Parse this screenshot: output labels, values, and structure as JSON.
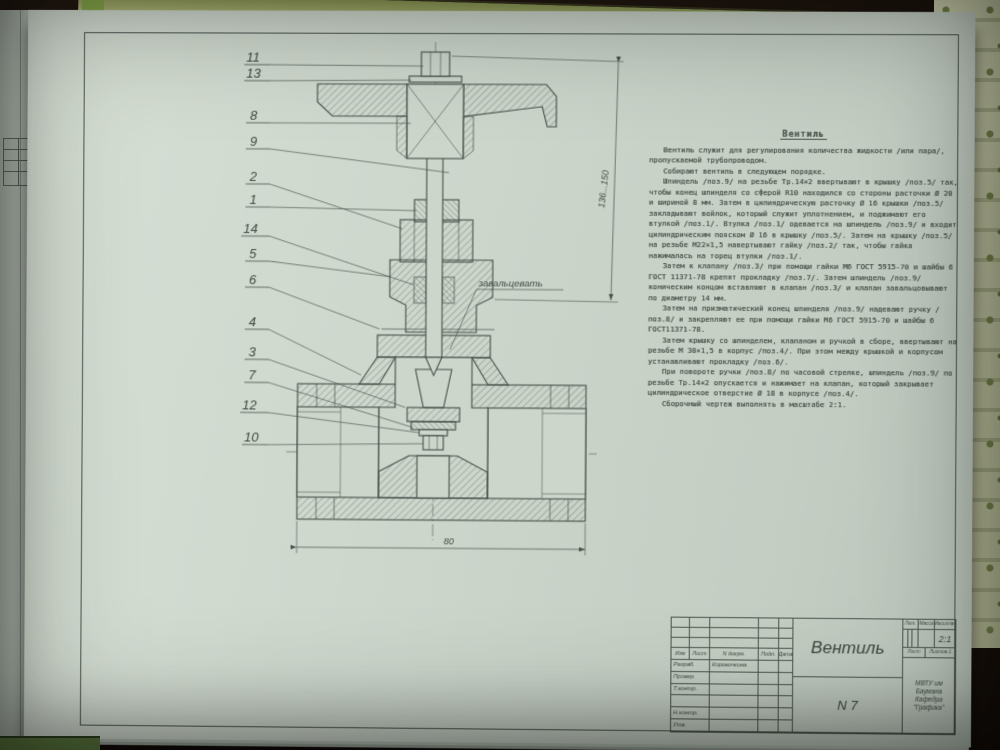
{
  "colors": {
    "paper": "#ccd6cb",
    "ink": "#46514a",
    "table_background": "#241a12",
    "wallpaper": "#c4c8a5",
    "cover_edge_green": "#b7bf7f",
    "corner_green": "#5e7b40"
  },
  "drawing": {
    "callouts": [
      "11",
      "13",
      "8",
      "9",
      "2",
      "1",
      "14",
      "5",
      "6",
      "4",
      "3",
      "7",
      "12",
      "10"
    ],
    "note_crimp": "завальцевать",
    "dim_height": "136...150",
    "dim_length": "80"
  },
  "spec_text": {
    "title": "Вентиль",
    "paragraphs": [
      "Вентиль служит для регулирования количества жидкости /или пара/, пропускаемой трубопроводом.",
      "Собирают вентиль в следующем порядке.",
      "Шпиндель /поз.9/ на резьбе Тр.14×2 ввертывают в крышку /поз.5/ так, чтобы конец шпинделя со сферой R10 находился со стороны расточки Ø 20 и шириной 8 мм. Затем в цилиндрическую расточку Ø 16 крышки /поз.5/ закладывают войлок, который служит уплотнением, и поджимают его втулкой /поз.1/. Втулка /поз.1/ одевается на шпиндель /поз.9/ и входит цилиндрическим пояском Ø 16 в крышку /поз.5/. Затем на крышку /поз.5/ на резьбе М22×1,5 навертывают гайку /поз.2/ так, чтобы гайка нажималась на торец втулки /поз.1/.",
      "Затем к клапану /поз.3/ при помощи гайки М6 ГОСТ 5915-70 и шайбы 6 ГОСТ 11371-78 крепят прокладку /поз.7/. Затем шпиндель /поз.9/ коническим концом вставляют в клапан /поз.3/ и клапан завальцовывают по диаметру 14 мм.",
      "Затем на призматический конец шпинделя /поз.9/ надевают ручку /поз.8/ и закрепляют ее при помощи гайки М6 ГОСТ 5915-70 и шайбы 6 ГОСТ11371-78.",
      "Затем крышку со шпинделем, клапаном и ручкой в сборе, ввертывают на резьбе М 30×1,5 в корпус /поз.4/. При этом между крышкой и корпусом устанавливают прокладку /поз.6/.",
      "При повороте ручки /поз.8/ по часовой стрелке, шпиндель /поз.9/ по резьбе Тр.14×2 опускается и нажимает на клапан, который закрывает цилиндрическое отверстие Ø 18 в корпусе /поз.4/.",
      "Сборочный чертеж выполнять в масштабе 2:1."
    ]
  },
  "title_block": {
    "cols": {
      "izm": "Изм",
      "list": "Лист",
      "ndoc": "N докум.",
      "podp": "Подп.",
      "data": "Дата"
    },
    "rows": [
      {
        "label": "Разраб.",
        "value": "Коровочкина"
      },
      {
        "label": "Провер.",
        "value": ""
      },
      {
        "label": "Т.контр.",
        "value": ""
      },
      {
        "label": "Н.контр.",
        "value": ""
      },
      {
        "label": "Утв.",
        "value": ""
      }
    ],
    "doc_title": "Вентиль",
    "doc_number": "N 7",
    "lit": "Лит.",
    "mass": "Масса",
    "scale": "Масштаб",
    "scale_value": "2:1",
    "sheet": "Лист",
    "sheets": "Листов 1",
    "org1": "МВТУ им Баумана",
    "org2": "Кафедра \"Графика\""
  }
}
